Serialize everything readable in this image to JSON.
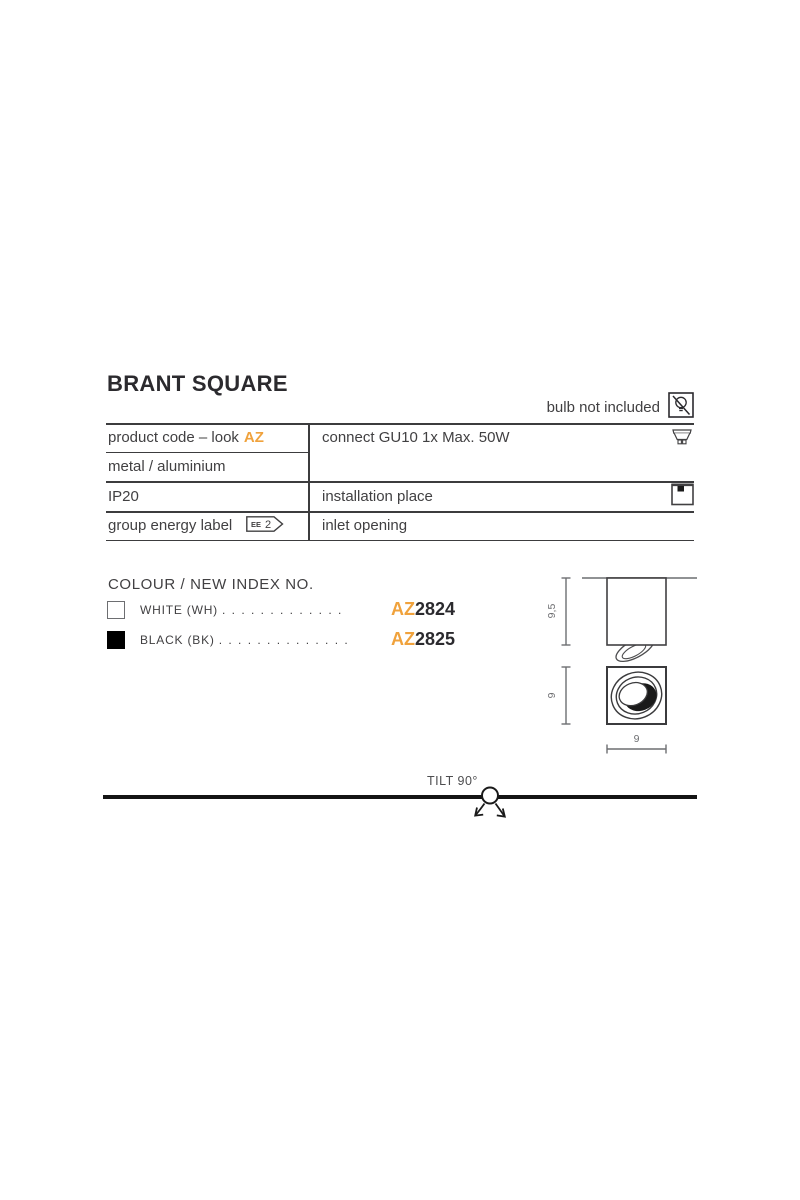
{
  "title": "BRANT SQUARE",
  "bulb_note": {
    "label": "bulb not included",
    "icon": "no-bulb-icon"
  },
  "spec": {
    "product_code_prefix": "product code – look",
    "product_code_accent": "AZ",
    "material": "metal / aluminium",
    "ip_rating": "IP20",
    "energy_label": "group energy label",
    "energy_badge_small": "EE",
    "energy_badge_value": "2",
    "connect": "connect GU10 1x Max. 50W",
    "installation": "installation place",
    "inlet": "inlet opening"
  },
  "icons": {
    "bulb_excluded": "no-bulb-icon",
    "socket": "gu10-bulb-icon",
    "mount": "ceiling-mount-icon"
  },
  "colour_section": {
    "heading": "COLOUR / NEW INDEX NO.",
    "options": [
      {
        "swatch_color": "#ffffff",
        "name": "WHITE (WH)",
        "dots": ". . . . . . . . . . . . .",
        "code_prefix": "AZ",
        "code_number": "2824"
      },
      {
        "swatch_color": "#000000",
        "name": "BLACK (BK)",
        "dots": ". . . . . . . . . . . . . .",
        "code_prefix": "AZ",
        "code_number": "2825"
      }
    ]
  },
  "drawings": {
    "side_height": "9,5",
    "front_height": "9",
    "front_width": "9"
  },
  "tilt_label": "TILT 90°",
  "colors": {
    "accent_orange": "#f0a23c",
    "text_dark": "#414042",
    "dim_gray": "#6d6e71",
    "line_dark": "#3c3c3e"
  }
}
